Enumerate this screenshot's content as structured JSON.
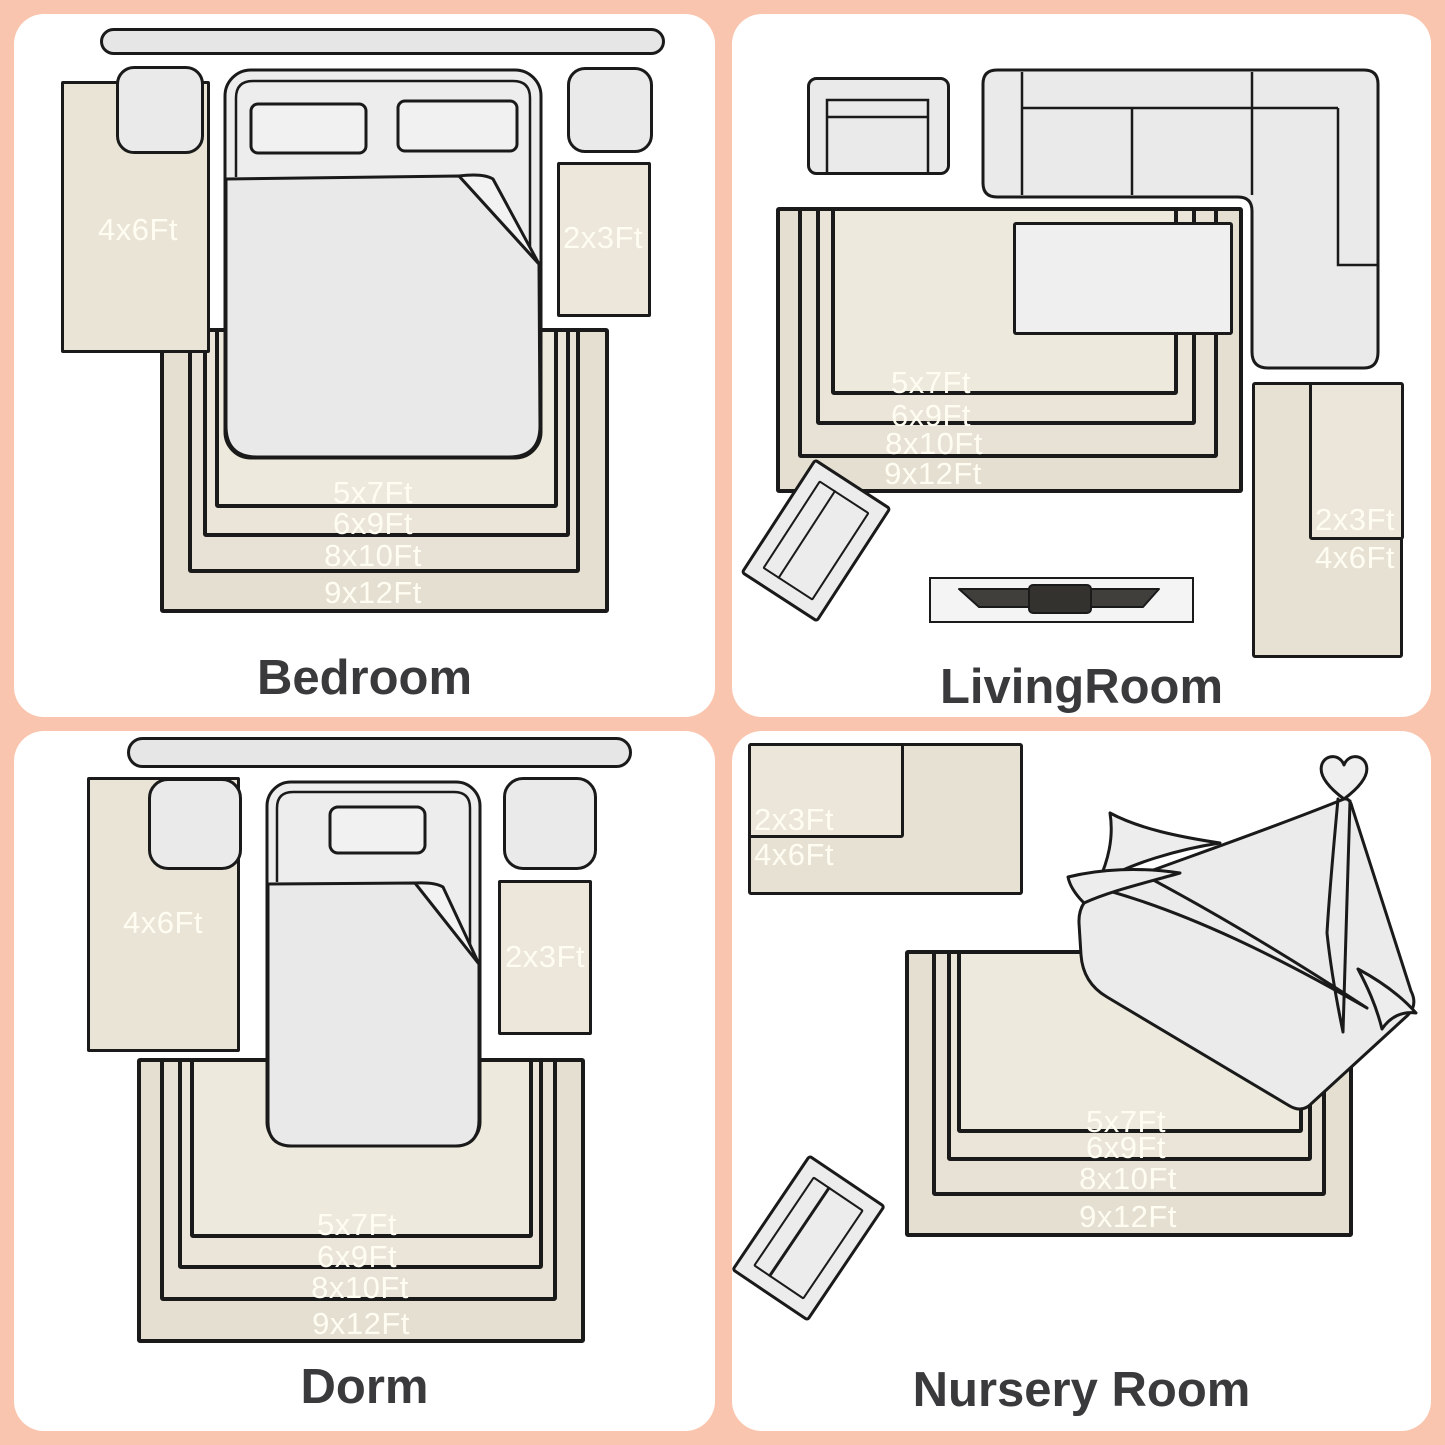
{
  "colors": {
    "background": "#FAC5AE",
    "panel": "#FFFFFF",
    "outline": "#1A1A1A",
    "size_label": "#FFFDF2",
    "title": "#3A3A3C",
    "rug_shades": [
      "#E4DFD1",
      "#E7E2D5",
      "#EAE5D8",
      "#EDE9DC"
    ]
  },
  "panels": {
    "bedroom": {
      "title": "Bedroom",
      "left_rug": "4x6Ft",
      "right_rug": "2x3Ft",
      "nested": [
        "5x7Ft",
        "6x9Ft",
        "8x10Ft",
        "9x12Ft"
      ]
    },
    "living_room": {
      "title": "LivingRoom",
      "corner_rug_inner": "2x3Ft",
      "corner_rug_outer": "4x6Ft",
      "nested": [
        "5x7Ft",
        "6x9Ft",
        "8x10Ft",
        "9x12Ft"
      ]
    },
    "dorm": {
      "title": "Dorm",
      "left_rug": "4x6Ft",
      "right_rug": "2x3Ft",
      "nested": [
        "5x7Ft",
        "6x9Ft",
        "8x10Ft",
        "9x12Ft"
      ]
    },
    "nursery": {
      "title": "Nursery Room",
      "corner_rug_inner": "2x3Ft",
      "corner_rug_outer": "4x6Ft",
      "nested": [
        "5x7Ft",
        "6x9Ft",
        "8x10Ft",
        "9x12Ft"
      ]
    }
  }
}
